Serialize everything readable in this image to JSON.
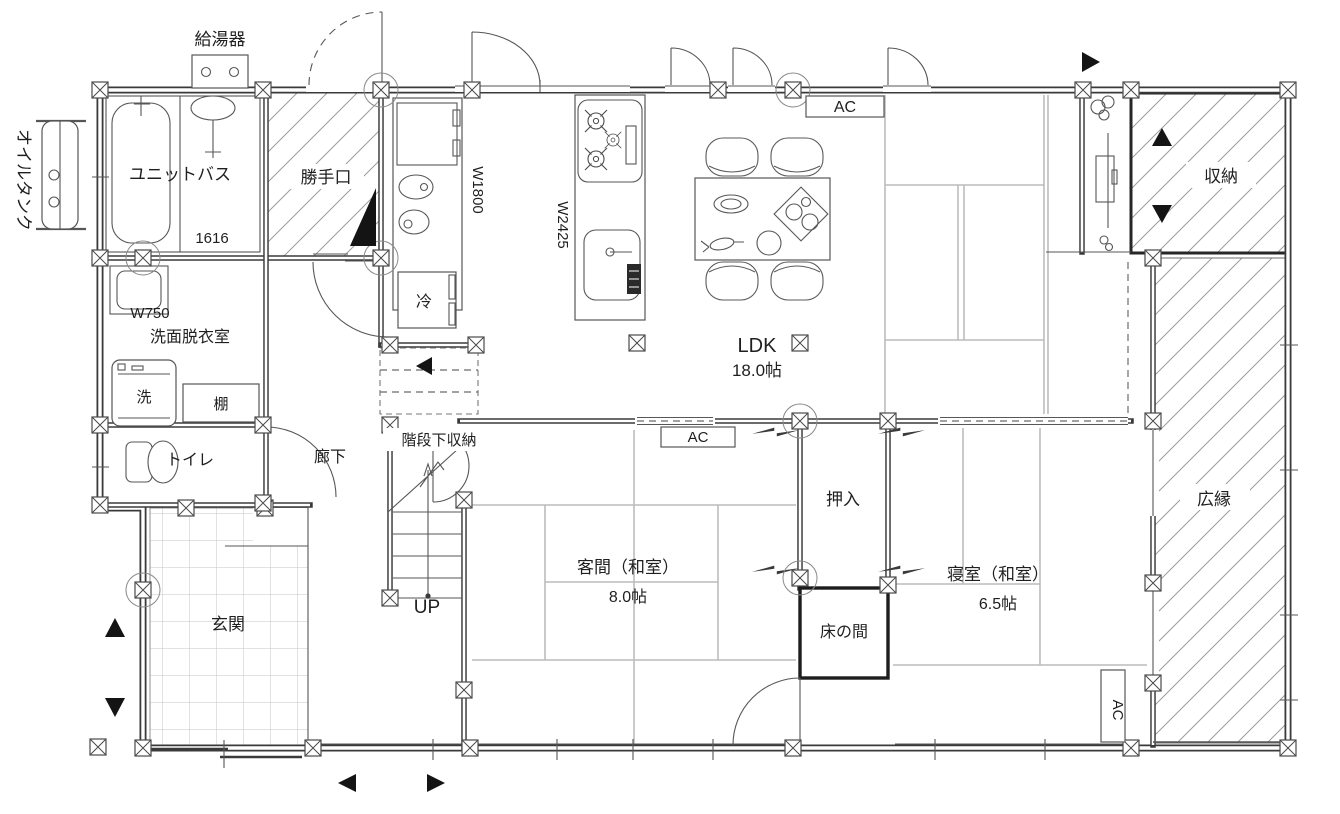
{
  "plan": {
    "exterior": {
      "oil_tank_label": "オイルタンク",
      "water_heater_label": "給湯器"
    },
    "rooms": {
      "unit_bath": {
        "name": "ユニットバス",
        "size": "1616"
      },
      "katteguchi": {
        "name": "勝手口"
      },
      "senmen": {
        "name": "洗面脱衣室",
        "width": "W750"
      },
      "toilet": {
        "name": "トイレ"
      },
      "rouka": {
        "name": "廊下"
      },
      "kaidan_shita": {
        "name": "階段下収納"
      },
      "genkan": {
        "name": "玄関"
      },
      "ldk": {
        "name": "LDK",
        "size": "18.0帖"
      },
      "kyakuma": {
        "name": "客間（和室）",
        "size": "8.0帖"
      },
      "shinshitsu": {
        "name": "寝室（和室）",
        "size": "6.5帖"
      },
      "oshiire": {
        "name": "押入"
      },
      "tokonoma": {
        "name": "床の間"
      },
      "shuno": {
        "name": "収納"
      },
      "hiroen": {
        "name": "広縁"
      }
    },
    "fixtures": {
      "refrigerator": "冷",
      "washing_machine": "洗",
      "shelf": "棚"
    },
    "dimensions": {
      "wash_counter": "W1800",
      "kitchen_counter": "W2425"
    },
    "annotations": {
      "ac": "AC",
      "up": "UP"
    },
    "colors": {
      "wall": "#3a3a3a",
      "thin_line": "#565656",
      "tatami_seam": "#bcbcbc",
      "hatch": "#9c9c9c",
      "background": "#ffffff"
    }
  }
}
